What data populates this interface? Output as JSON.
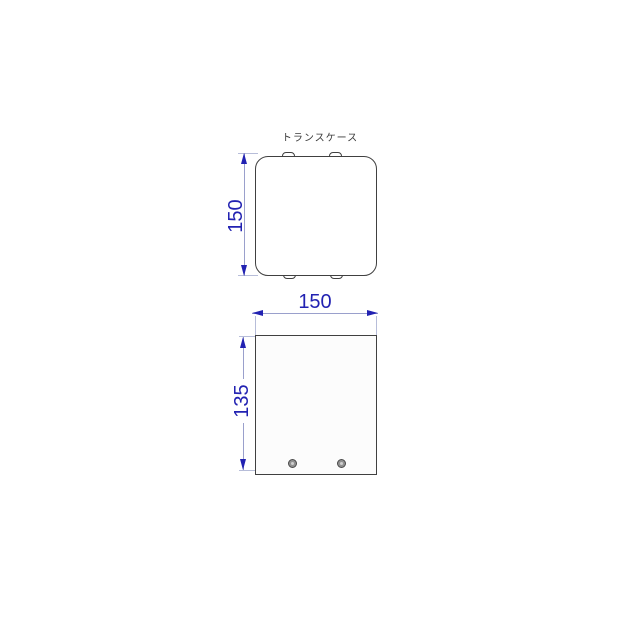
{
  "title": "トランスケース",
  "colors": {
    "background": "#ffffff",
    "outline": "#404040",
    "dimension_accent": "#2222b2",
    "dimension_line": "#9aa0cc",
    "extension_line": "#b7bdd9",
    "screw_fill": "#919191"
  },
  "dimensions": {
    "top_view_height": "150",
    "front_view_width": "150",
    "front_view_height": "135"
  },
  "views": {
    "top_view_name": "top-view",
    "front_view_name": "front-view",
    "screw_count": 2
  }
}
